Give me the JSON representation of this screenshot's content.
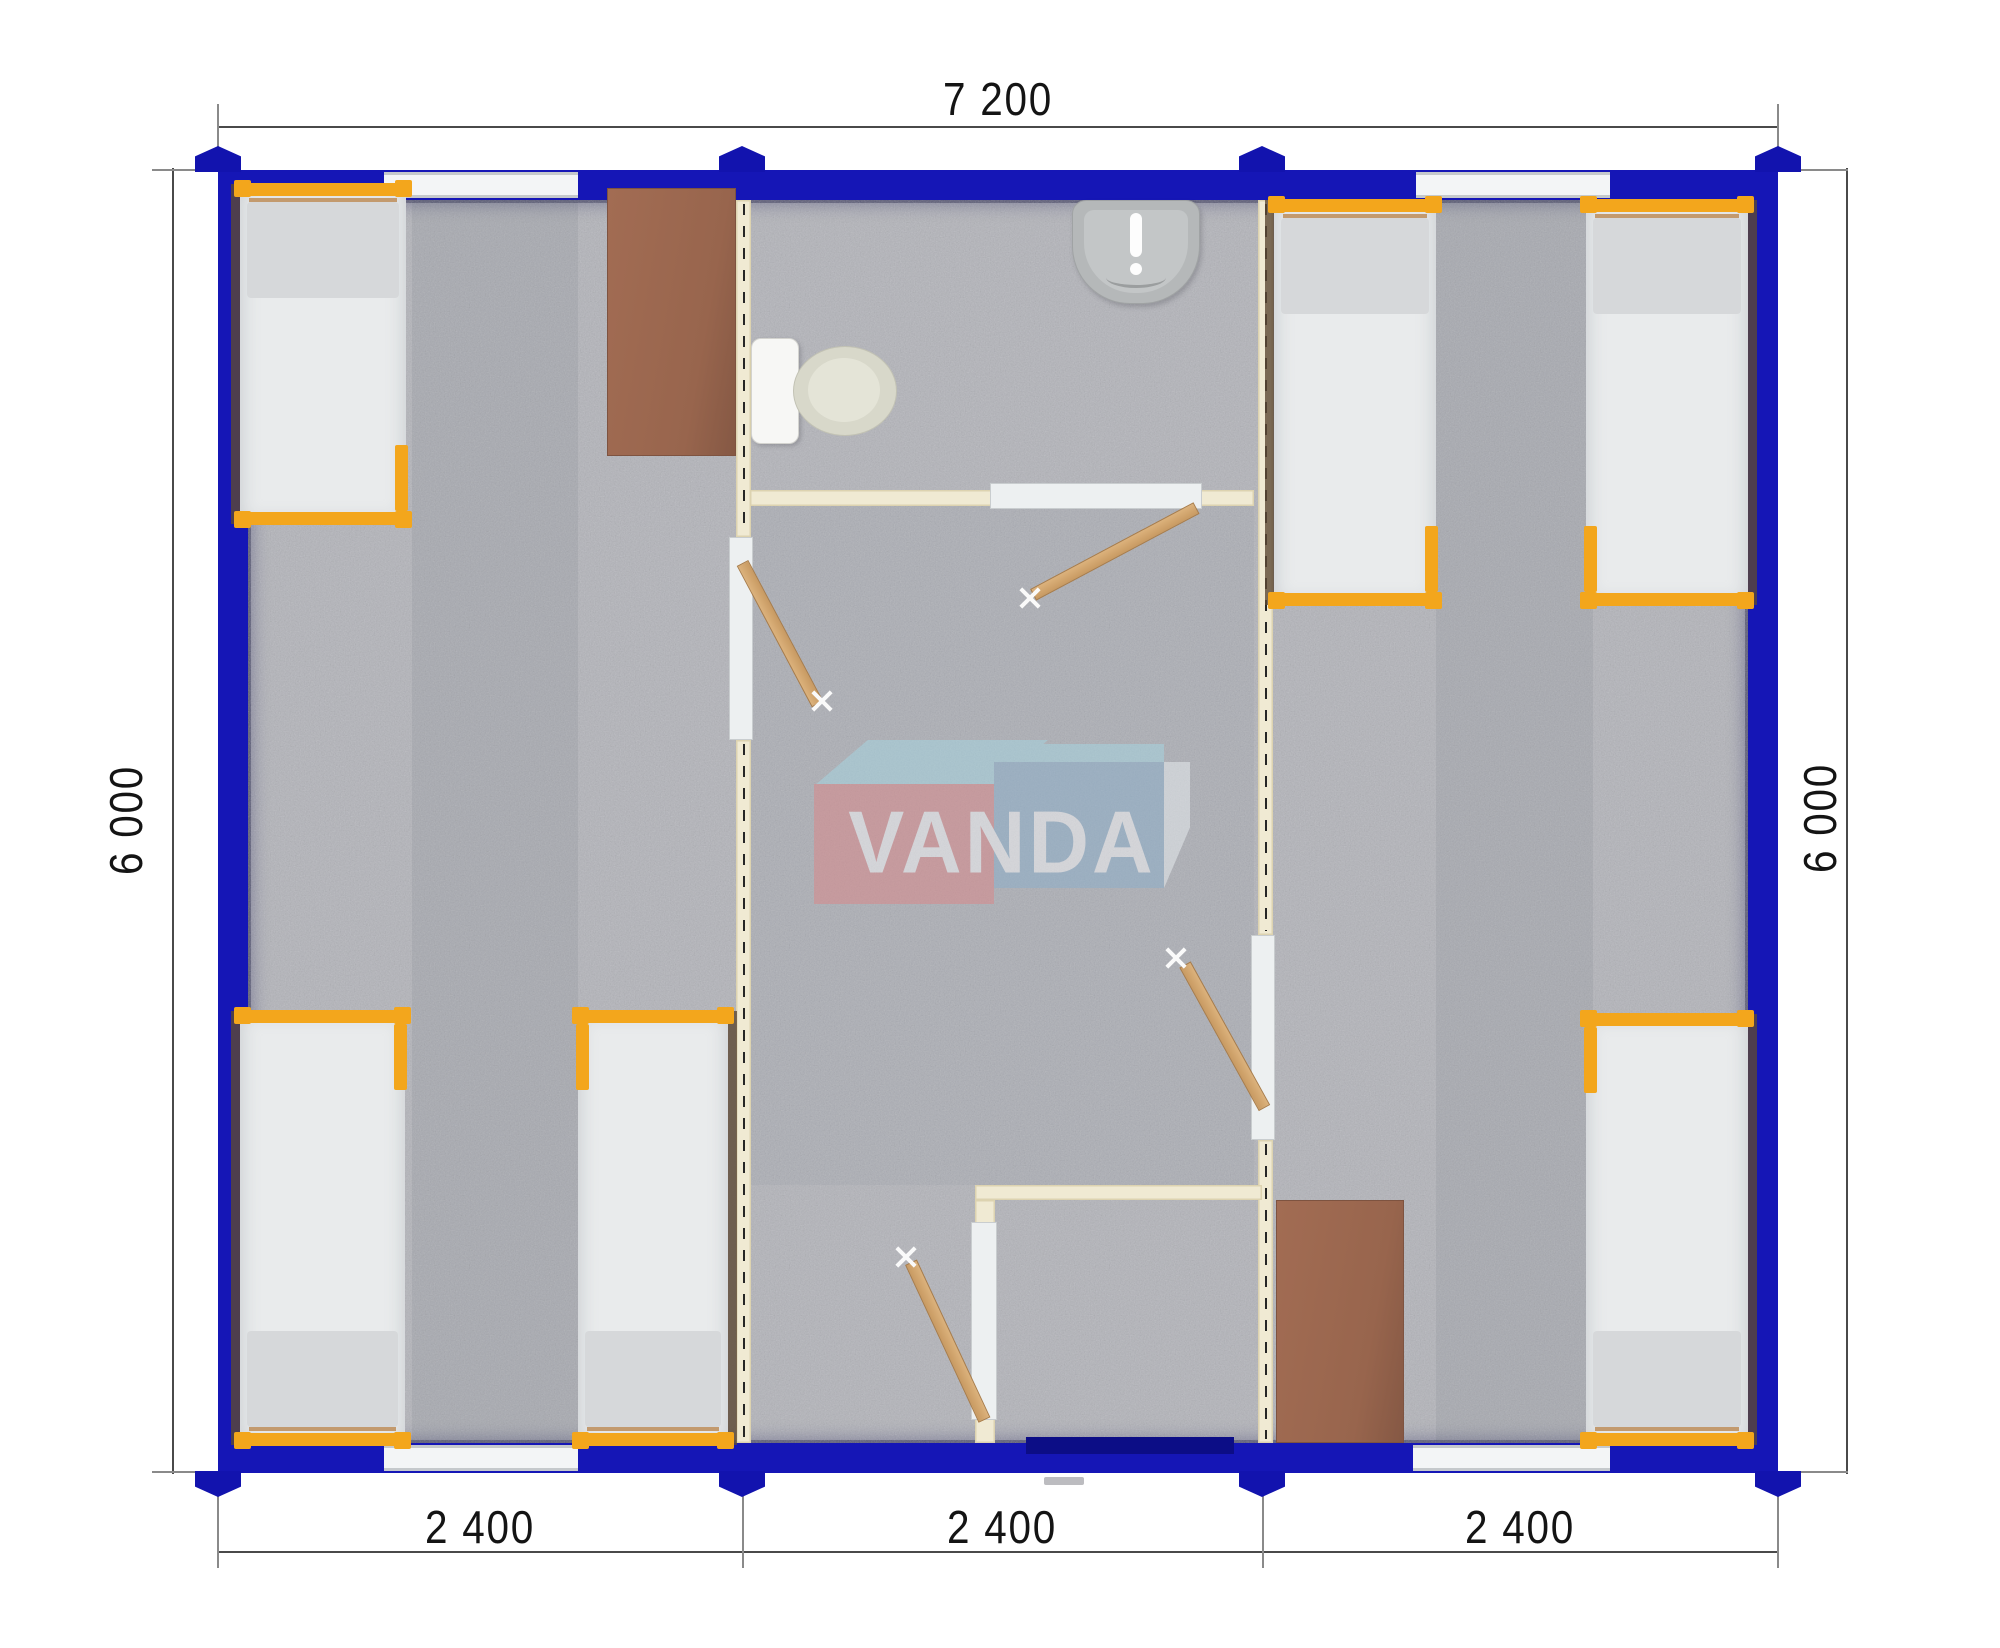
{
  "watermark": {
    "text": "VANDA",
    "colors": {
      "red_box": "#db8789",
      "blue_box": "#8cafcb",
      "cyan_top": "#a6d6e2",
      "letters": "#f5f5f7"
    }
  },
  "dimensions": {
    "top": {
      "label": "7 200"
    },
    "left": {
      "label": "6 000"
    },
    "right": {
      "label": "6 000"
    },
    "bottom": {
      "segments": [
        {
          "label": "2 400"
        },
        {
          "label": "2 400"
        },
        {
          "label": "2 400"
        }
      ]
    }
  },
  "plan": {
    "type": "modular-building-floor-plan",
    "total_width_mm": 7200,
    "total_depth_mm": 6000,
    "modules": 3,
    "module_width_mm": 2400,
    "rooms": [
      "left bedroom",
      "bathroom",
      "corridor",
      "entrance vestibule",
      "right bedroom"
    ],
    "furniture": {
      "beds": 6,
      "desks": 2,
      "toilets": 1,
      "washbasins": 1
    },
    "openings": {
      "windows": 4,
      "interior_doors": 4,
      "entrance_doors": 1
    }
  },
  "colors": {
    "exterior_wall": "#1516b6",
    "partition_wall": "#f0ead3",
    "carpet": "#b3b4ba",
    "bed_frame": "#f3a61c",
    "mattress": "#e9ebec",
    "desk": "#9c6852",
    "door_leaf": "#d2a36e",
    "dimension_text": "#141414"
  }
}
